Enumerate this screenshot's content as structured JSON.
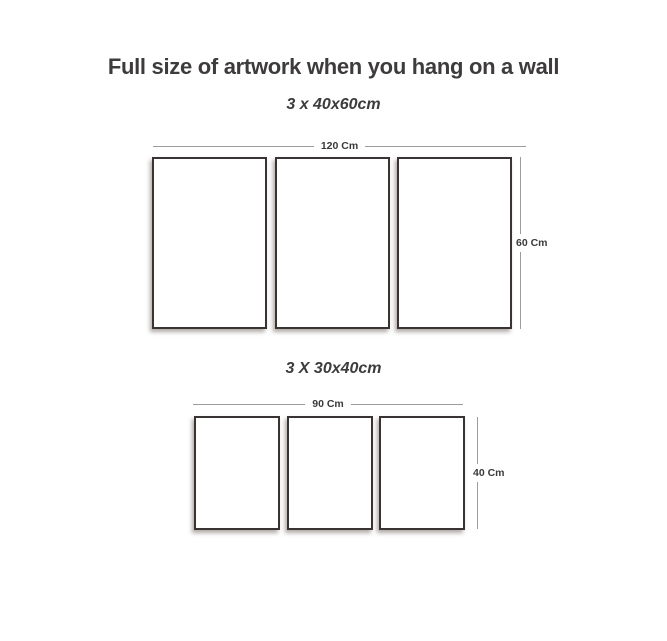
{
  "page": {
    "title": "Full size of artwork when you hang on a wall",
    "background_color": "#ffffff",
    "text_color": "#3d3b3c",
    "dimension_line_color": "#9c9c9c",
    "panel_border_color": "#3a3334"
  },
  "groups": [
    {
      "label": "3 x 40x60cm",
      "width_label": "120 Cm",
      "height_label": "60 Cm",
      "panel_count": 3
    },
    {
      "label": "3 X 30x40cm",
      "width_label": "90 Cm",
      "height_label": "40 Cm",
      "panel_count": 3
    }
  ]
}
